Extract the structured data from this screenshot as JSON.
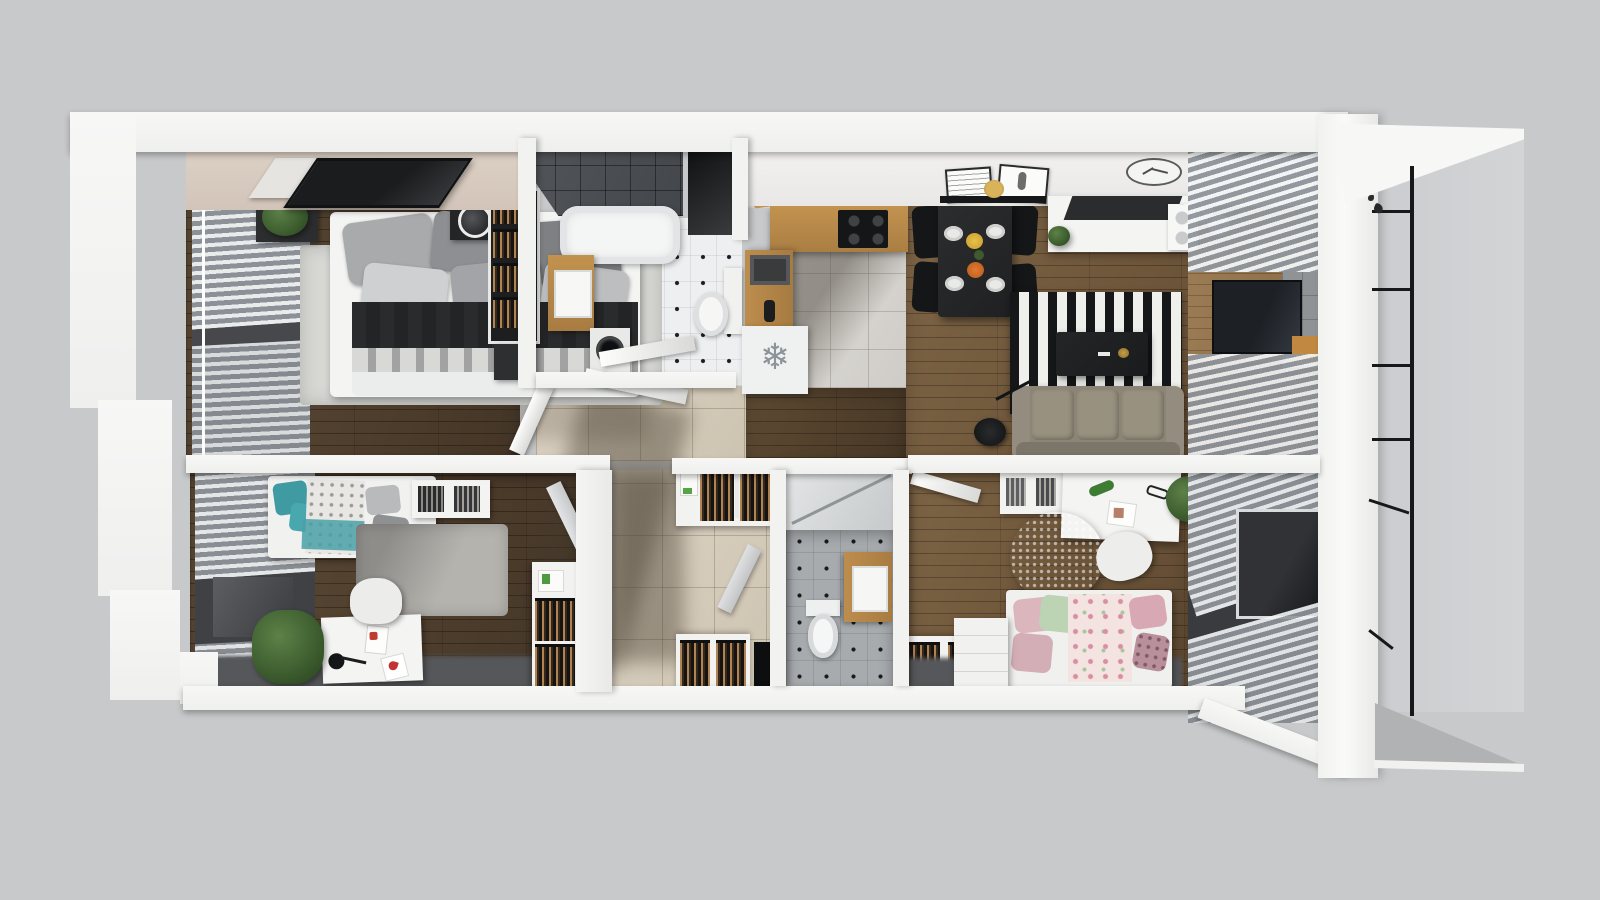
{
  "scene": {
    "type": "3d-apartment-floor-plan-render",
    "view": "top-down dollhouse cutaway",
    "background": "#c8c9cb",
    "palette": {
      "outer_wall": "#f6f6f5",
      "ceiling_tan": "#d8cbc0",
      "wood_floor_dark": "#50402e",
      "wood_floor_mid": "#6d5539",
      "hall_tile_beige": "#d5cbbb",
      "bath_tile_white": "#edeff0",
      "wc_tile_gray": "#a7abae",
      "shower_tile_dark": "#4a4d51",
      "counter_wood": "#b5854e",
      "rug_stripe_black": "#161719",
      "rug_stripe_white": "#efefec",
      "sofa_taupe": "#8b8477",
      "teal_bedding": "#49a0a8",
      "pink_bedding": "#dcb6bd",
      "green_pillow": "#bcd3b4",
      "railing_black": "#17181a",
      "dining_set_black": "#232426"
    },
    "icons": {
      "fridge_snowflake": "❄"
    },
    "rooms": [
      {
        "id": "master-bedroom",
        "furniture": [
          "double-bed",
          "gray-pillows",
          "dark-throw",
          "area-rug",
          "nightstand",
          "table-lamp",
          "open-wardrobe",
          "dresser",
          "plant",
          "wall-tv",
          "window-blinds"
        ]
      },
      {
        "id": "bathroom",
        "furniture": [
          "bathtub",
          "washing-machine",
          "wood-vanity-sink",
          "toilet",
          "dot-tile-floor",
          "dark-shower-wall",
          "door"
        ]
      },
      {
        "id": "kitchen",
        "furniture": [
          "upper-cabinets",
          "cooktop",
          "wood-counter",
          "sink",
          "fridge-freezer",
          "tile-floor"
        ]
      },
      {
        "id": "dining-area",
        "furniture": [
          "black-table",
          "four-chairs",
          "plates",
          "bowls",
          "wall-shelf",
          "picture-frames",
          "wall-clock"
        ]
      },
      {
        "id": "living-room",
        "furniture": [
          "sofa",
          "striped-rug",
          "coffee-table",
          "arc-floor-lamp",
          "sideboard",
          "plant",
          "media-wall-tv",
          "window-blinds",
          "ceiling-spotlights"
        ]
      },
      {
        "id": "hallway",
        "furniture": [
          "open-closets",
          "beige-tile-floor",
          "doors"
        ]
      },
      {
        "id": "wc",
        "furniture": [
          "toilet",
          "wood-vanity-sink",
          "shower",
          "gray-dot-tile-floor",
          "door"
        ]
      },
      {
        "id": "kids-room",
        "furniture": [
          "teal-daybed",
          "bookshelf",
          "desk",
          "desk-lamp",
          "chair",
          "gray-rug",
          "palm-plant",
          "wardrobe",
          "window-blinds"
        ]
      },
      {
        "id": "teen-room",
        "furniture": [
          "bed",
          "floral-bedding",
          "round-fluffy-rug",
          "desk",
          "chair",
          "shelf",
          "dresser",
          "plant",
          "window-blinds"
        ]
      },
      {
        "id": "balcony",
        "furniture": [
          "black-railing",
          "glass-wall",
          "roof-slab",
          "floor-slab"
        ]
      }
    ]
  }
}
